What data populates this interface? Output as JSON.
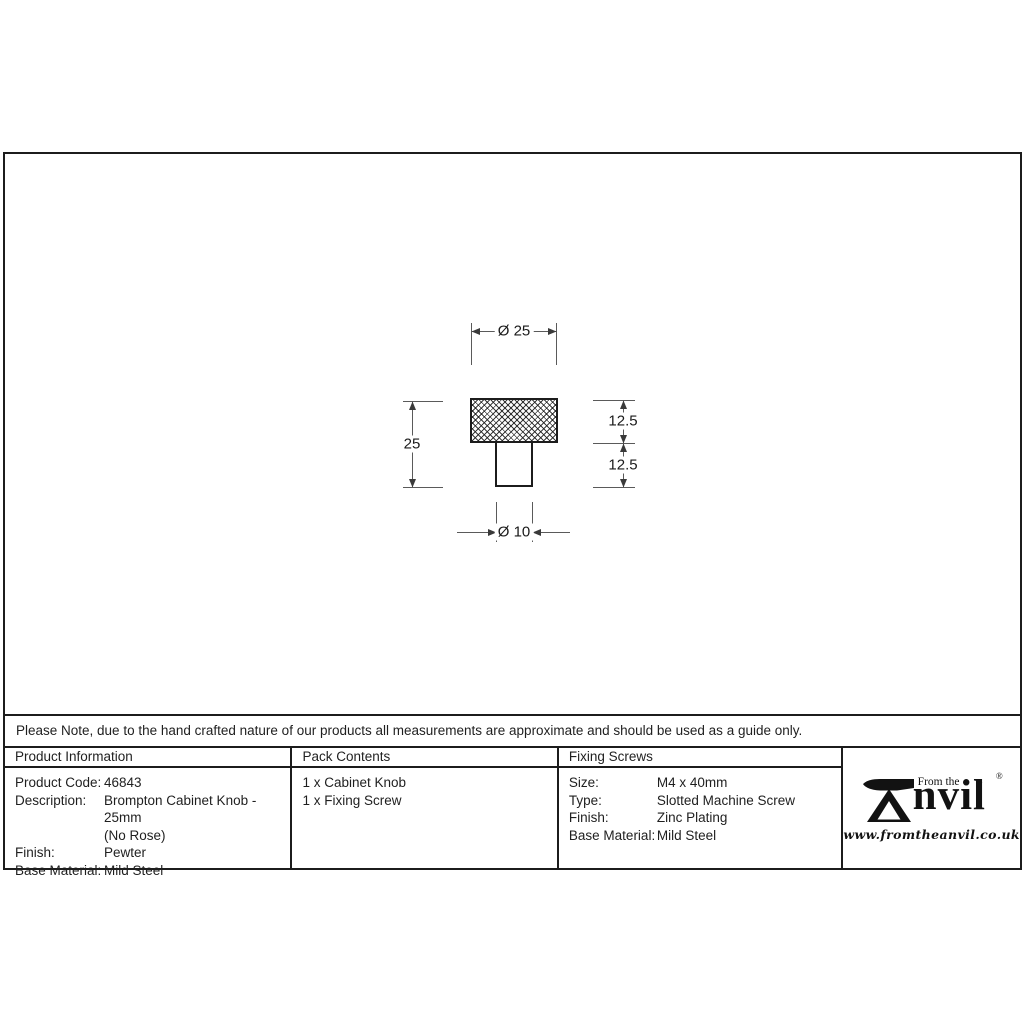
{
  "drawing": {
    "dim_head_diameter": "Ø 25",
    "dim_total_height": "25",
    "dim_head_height": "12.5",
    "dim_stem_height": "12.5",
    "dim_stem_diameter": "Ø 10"
  },
  "note": "Please Note, due to the hand crafted nature of our products all measurements are approximate and should be used as a guide only.",
  "tables": {
    "product_information": {
      "header": "Product Information",
      "rows": [
        {
          "label": "Product Code:",
          "value": "46843"
        },
        {
          "label": "Description:",
          "value": "Brompton Cabinet Knob - 25mm"
        },
        {
          "label": "",
          "value": "(No Rose)"
        },
        {
          "label": "Finish:",
          "value": "Pewter"
        },
        {
          "label": "Base Material:",
          "value": "Mild Steel"
        }
      ]
    },
    "pack_contents": {
      "header": "Pack Contents",
      "items": [
        "1 x Cabinet Knob",
        "1 x Fixing Screw"
      ]
    },
    "fixing_screws": {
      "header": "Fixing Screws",
      "rows": [
        {
          "label": "Size:",
          "value": "M4 x 40mm"
        },
        {
          "label": "Type:",
          "value": "Slotted Machine Screw"
        },
        {
          "label": "Finish:",
          "value": "Zinc Plating"
        },
        {
          "label": "Base Material:",
          "value": "Mild Steel"
        }
      ]
    }
  },
  "brand": {
    "prefix": "From the",
    "star": "✦",
    "name_rest": "nvil",
    "registered": "®",
    "url": "www.fromtheanvil.co.uk"
  },
  "colors": {
    "object_line": "#1c1c1c",
    "dimension_line": "#5a5a5a",
    "text": "#1f1f1f",
    "background": "#ffffff"
  }
}
